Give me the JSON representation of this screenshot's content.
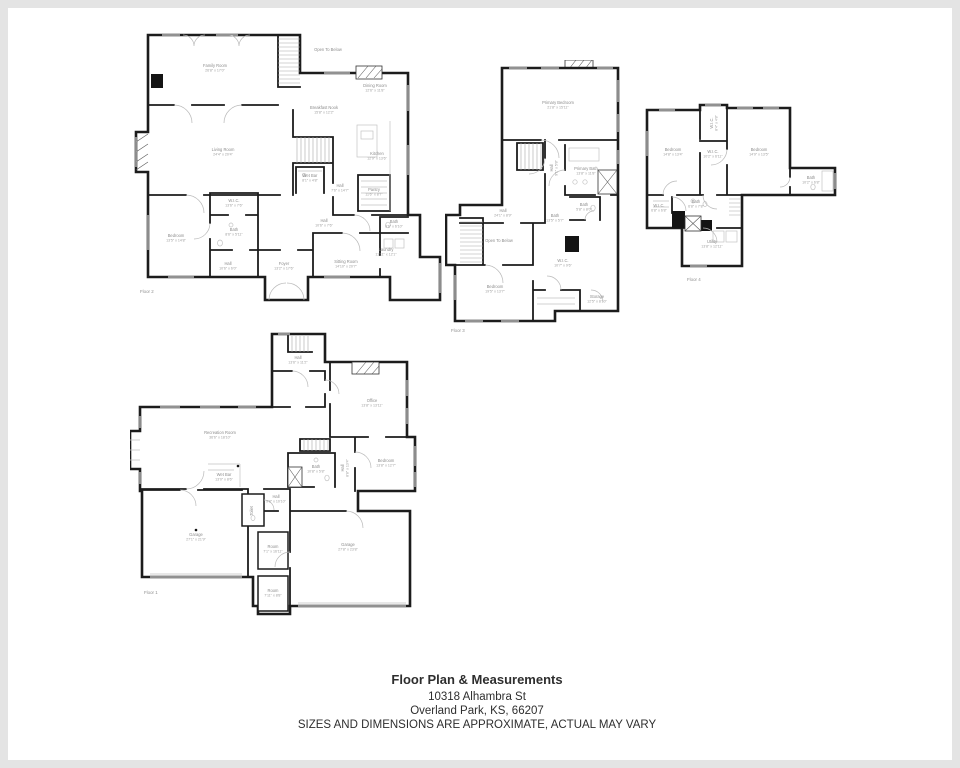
{
  "page": {
    "background": "#ffffff",
    "frame_color": "#e4e4e4",
    "wall_color": "#1c1c1c",
    "label_color": "#8d8d8d"
  },
  "footer": {
    "title": "Floor Plan & Measurements",
    "address_line1": "10318 Alhambra St",
    "address_line2": "Overland Park, KS, 66207",
    "disclaimer": "SIZES AND DIMENSIONS ARE APPROXIMATE, ACTUAL MAY VARY"
  },
  "floors": [
    {
      "id": "floor2",
      "name": "Floor 2",
      "label_pos": {
        "x": 12,
        "y": 268
      },
      "rooms": [
        {
          "name": "Family Room",
          "dims": "26'8\" x 17'0\"",
          "x": 87,
          "y": 42
        },
        {
          "name": "Open To Below",
          "x": 200,
          "y": 26,
          "size": 3.2
        },
        {
          "name": "Dining Room",
          "dims": "12'6\" x 11'8\"",
          "x": 247,
          "y": 62
        },
        {
          "name": "Breakfast Nook",
          "dims": "15'8\" x 12'2\"",
          "x": 196,
          "y": 84
        },
        {
          "name": "Living Room",
          "dims": "24'4\" x 20'4\"",
          "x": 95,
          "y": 126
        },
        {
          "name": "Kitchen",
          "dims": "12'9\" x 13'6\"",
          "x": 249,
          "y": 130
        },
        {
          "name": "Wet Bar",
          "dims": "8'1\" x 4'8\"",
          "x": 182,
          "y": 152
        },
        {
          "name": "Hall",
          "dims": "7'6\" x 14'7\"",
          "x": 212,
          "y": 162
        },
        {
          "name": "Pantry",
          "dims": "11'6\" x 8'7\"",
          "x": 246,
          "y": 166
        },
        {
          "name": "Hall",
          "dims": "10'6\" x 7'6\"",
          "x": 196,
          "y": 197
        },
        {
          "name": "Bath",
          "dims": "6'6\" x 6'10\"",
          "x": 266,
          "y": 198
        },
        {
          "name": "W.I.C.",
          "dims": "13'6\" x 7'6\"",
          "x": 106,
          "y": 177
        },
        {
          "name": "Bath",
          "dims": "8'6\" x 5'11\"",
          "x": 106,
          "y": 206
        },
        {
          "name": "Bedroom",
          "dims": "13'5\" x 14'8\"",
          "x": 48,
          "y": 212
        },
        {
          "name": "Hall",
          "dims": "10'6\" x 6'0\"",
          "x": 100,
          "y": 240
        },
        {
          "name": "Foyer",
          "dims": "13'2\" x 17'6\"",
          "x": 156,
          "y": 240
        },
        {
          "name": "Sitting Room",
          "dims": "14'10\" x 20'7\"",
          "x": 218,
          "y": 238
        },
        {
          "name": "Laundry",
          "dims": "11'11\" x 12'1\"",
          "x": 258,
          "y": 226
        }
      ]
    },
    {
      "id": "floor3",
      "name": "Floor 3",
      "label_pos": {
        "x": 6,
        "y": 272
      },
      "rooms": [
        {
          "name": "Primary Bedroom",
          "dims": "21'8\" x 15'11\"",
          "x": 113,
          "y": 44
        },
        {
          "name": "Hall",
          "dims": "9'1\" x 5'8\"",
          "x": 108,
          "y": 108,
          "rot": -90
        },
        {
          "name": "Primary Bath",
          "dims": "13'8\" x 11'8\"",
          "x": 141,
          "y": 110
        },
        {
          "name": "Bath",
          "dims": "5'8\" x 8'0\"",
          "x": 139,
          "y": 146
        },
        {
          "name": "Hall",
          "dims": "24'1\" x 8'9\"",
          "x": 58,
          "y": 152
        },
        {
          "name": "Bath",
          "dims": "13'5\" x 5'7\"",
          "x": 110,
          "y": 157
        },
        {
          "name": "Open To Below",
          "x": 54,
          "y": 182,
          "size": 3.2
        },
        {
          "name": "Bedroom",
          "dims": "19'5\" x 13'7\"",
          "x": 50,
          "y": 228
        },
        {
          "name": "W.I.C.",
          "dims": "10'7\" x 9'6\"",
          "x": 118,
          "y": 202
        },
        {
          "name": "Storage",
          "dims": "12'5\" x 8'10\"",
          "x": 152,
          "y": 238
        }
      ]
    },
    {
      "id": "floor4",
      "name": "Floor 4",
      "label_pos": {
        "x": 42,
        "y": 180
      },
      "rooms": [
        {
          "name": "Bedroom",
          "dims": "14'8\" x 13'4\"",
          "x": 28,
          "y": 50
        },
        {
          "name": "W.I.C.",
          "dims": "8'4\" x 4'8\"",
          "x": 68,
          "y": 22,
          "rot": -90
        },
        {
          "name": "W.I.C.",
          "dims": "10'2\" x 6'11\"",
          "x": 68,
          "y": 52
        },
        {
          "name": "Bedroom",
          "dims": "14'9\" x 13'5\"",
          "x": 114,
          "y": 50
        },
        {
          "name": "Bath",
          "dims": "10'2\" x 6'8\"",
          "x": 166,
          "y": 78
        },
        {
          "name": "W.I.C.",
          "dims": "6'8\" x 6'8\"",
          "x": 14,
          "y": 106
        },
        {
          "name": "Bath",
          "dims": "6'8\" x 7'8\"",
          "x": 51,
          "y": 102
        },
        {
          "name": "Utility",
          "dims": "13'8\" x 12'11\"",
          "x": 67,
          "y": 142
        }
      ]
    },
    {
      "id": "floor1",
      "name": "Floor 1",
      "label_pos": {
        "x": 14,
        "y": 262
      },
      "rooms": [
        {
          "name": "Hall",
          "dims": "13'6\" x 11'2\"",
          "x": 168,
          "y": 27
        },
        {
          "name": "Office",
          "dims": "13'8\" x 13'11\"",
          "x": 242,
          "y": 70
        },
        {
          "name": "Recreation Room",
          "dims": "36'6\" x 18'10\"",
          "x": 90,
          "y": 102
        },
        {
          "name": "Wet Bar",
          "dims": "13'0\" x 8'6\"",
          "x": 94,
          "y": 144
        },
        {
          "name": "Bath",
          "dims": "10'8\" x 5'8\"",
          "x": 186,
          "y": 136
        },
        {
          "name": "Hall",
          "dims": "8'8\" x 13'4\"",
          "x": 214,
          "y": 136,
          "rot": -90
        },
        {
          "name": "Bedroom",
          "dims": "13'8\" x 12'7\"",
          "x": 256,
          "y": 130
        },
        {
          "name": "Hall",
          "dims": "9'8\" x 10'10\"",
          "x": 146,
          "y": 166
        },
        {
          "name": "Toilet",
          "x": 123,
          "y": 179,
          "rot": -90,
          "size": 3.4
        },
        {
          "name": "Garage",
          "dims": "27'1\" x 21'9\"",
          "x": 66,
          "y": 204
        },
        {
          "name": "Room",
          "dims": "7'1\" x 16'11\"",
          "x": 143,
          "y": 216
        },
        {
          "name": "Garage",
          "dims": "27'8\" x 23'8\"",
          "x": 218,
          "y": 214
        },
        {
          "name": "Room",
          "dims": "7'11\" x 8'8\"",
          "x": 143,
          "y": 260
        }
      ]
    }
  ]
}
